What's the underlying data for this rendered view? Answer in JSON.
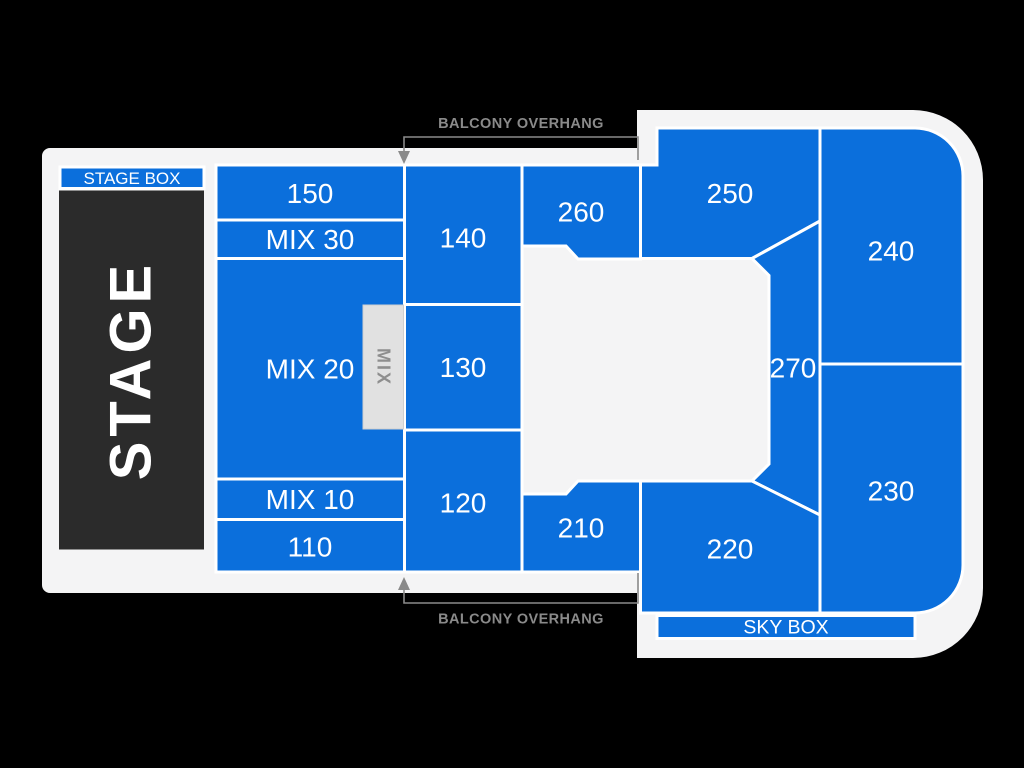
{
  "title": "Venue seating chart",
  "colors": {
    "background": "#000000",
    "floor": "#f4f4f5",
    "section_fill": "#0b6fdc",
    "section_divider": "#ffffff",
    "stage_fill": "#2b2b2b",
    "label_text": "#ffffff",
    "mix_booth_fill": "#e1e1e1",
    "mix_booth_text": "#8e8e8e",
    "annotation_text": "#8a8a8a"
  },
  "stage": {
    "label": "STAGE"
  },
  "stage_box": {
    "label": "STAGE BOX"
  },
  "sky_box": {
    "label": "SKY BOX"
  },
  "mix_booth": {
    "label": "MIX"
  },
  "balcony_overhang": {
    "top_label": "BALCONY OVERHANG",
    "bottom_label": "BALCONY OVERHANG"
  },
  "sections": [
    {
      "id": "150",
      "label": "150"
    },
    {
      "id": "mix-30",
      "label": "MIX 30"
    },
    {
      "id": "mix-20",
      "label": "MIX 20"
    },
    {
      "id": "mix-10",
      "label": "MIX 10"
    },
    {
      "id": "110",
      "label": "110"
    },
    {
      "id": "140",
      "label": "140"
    },
    {
      "id": "130",
      "label": "130"
    },
    {
      "id": "120",
      "label": "120"
    },
    {
      "id": "260",
      "label": "260"
    },
    {
      "id": "210",
      "label": "210"
    },
    {
      "id": "250",
      "label": "250"
    },
    {
      "id": "240",
      "label": "240"
    },
    {
      "id": "270",
      "label": "270"
    },
    {
      "id": "230",
      "label": "230"
    },
    {
      "id": "220",
      "label": "220"
    }
  ]
}
